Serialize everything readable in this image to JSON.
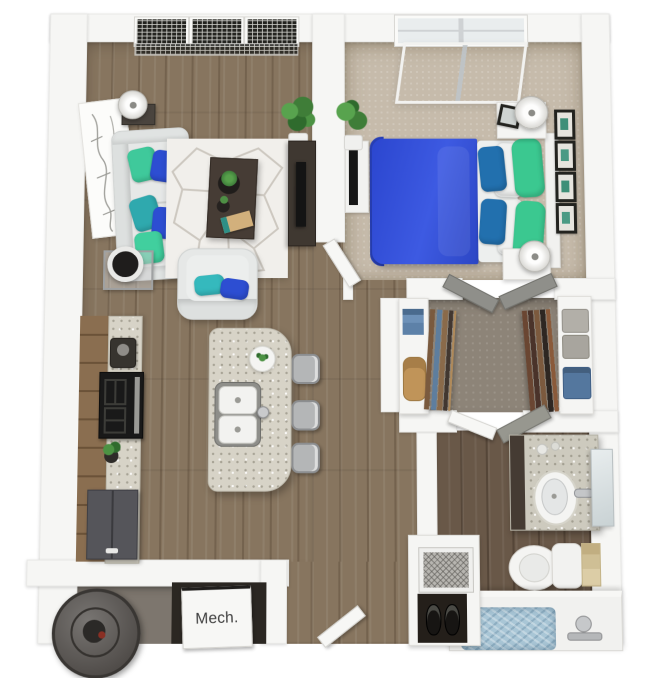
{
  "labels": {
    "mech_room": "Mech."
  },
  "scene": {
    "type": "3d-floor-plan-render",
    "rooms": [
      "living-room",
      "kitchen",
      "bedroom",
      "walk-in-closet",
      "bathroom",
      "mech-room",
      "entry-hall"
    ],
    "furniture": [
      "sofa",
      "armchair",
      "rug",
      "coffee-table",
      "floor-lamps",
      "tv-console",
      "wall-art",
      "plants",
      "kitchen-cabinets",
      "stove",
      "refrigerator",
      "island-with-double-sink",
      "bar-stools",
      "bed",
      "nightstands",
      "wall-frames",
      "closet-shelves",
      "hanging-clothes",
      "vanity-sink",
      "mirror",
      "toilet",
      "towel",
      "bathtub",
      "water-heater",
      "entry-closet",
      "shoes"
    ]
  },
  "palette": {
    "wall": "#f6f6f4",
    "wood_floor": "#87755f",
    "bedroom_carpet": "#c6bbab",
    "closet_floor": "#8d8478",
    "sofa": "#e6e8e7",
    "accent_teal": "#3fc99b",
    "accent_blue": "#2d4ed2",
    "bed_blue": "#2b46cf",
    "bed_green": "#3bc890",
    "bed_pillow_blue": "#2270ae",
    "cabinet_brown": "#8a6e50",
    "counter_granite": "#d7d3c7",
    "appliance_gray": "#55555a",
    "tub_water": "#a9c6d6"
  }
}
